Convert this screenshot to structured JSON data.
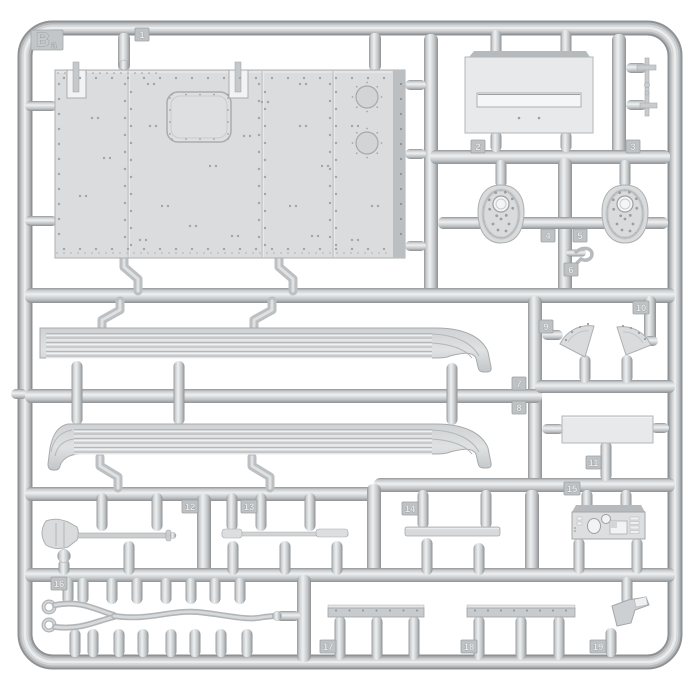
{
  "sprue": {
    "brand_letter": "B",
    "brand_letter_sub": "a",
    "parts": [
      {
        "number": "1",
        "shape": "large riveted roof panel"
      },
      {
        "number": "2",
        "shape": "slotted rectangular plate"
      },
      {
        "number": "3",
        "shape": "small control lever"
      },
      {
        "number": "4",
        "shape": "perforated oval cover"
      },
      {
        "number": "5",
        "shape": "perforated oval cover"
      },
      {
        "number": "6",
        "shape": "small hook"
      },
      {
        "number": "7",
        "shape": "long ribbed fender"
      },
      {
        "number": "8",
        "shape": "long ribbed fender"
      },
      {
        "number": "9",
        "shape": "fan shaped sector plate"
      },
      {
        "number": "10",
        "shape": "fan shaped sector plate"
      },
      {
        "number": "11",
        "shape": "flat rectangular plate"
      },
      {
        "number": "12",
        "shape": "shovel"
      },
      {
        "number": "13",
        "shape": "thin rod tool"
      },
      {
        "number": "14",
        "shape": "flat bar"
      },
      {
        "number": "15",
        "shape": "instrument panel"
      },
      {
        "number": "16",
        "shape": "tow cable with eyelets"
      },
      {
        "number": "17",
        "shape": "riveted rail"
      },
      {
        "number": "18",
        "shape": "riveted rail"
      },
      {
        "number": "19",
        "shape": "small bracket"
      }
    ]
  },
  "colors": {
    "background": "#ffffff",
    "plastic_mid": "#c6c9cb",
    "plastic_light": "#eceeef",
    "plastic_dark": "#94979a",
    "part_surface": "#d9dbdc"
  }
}
